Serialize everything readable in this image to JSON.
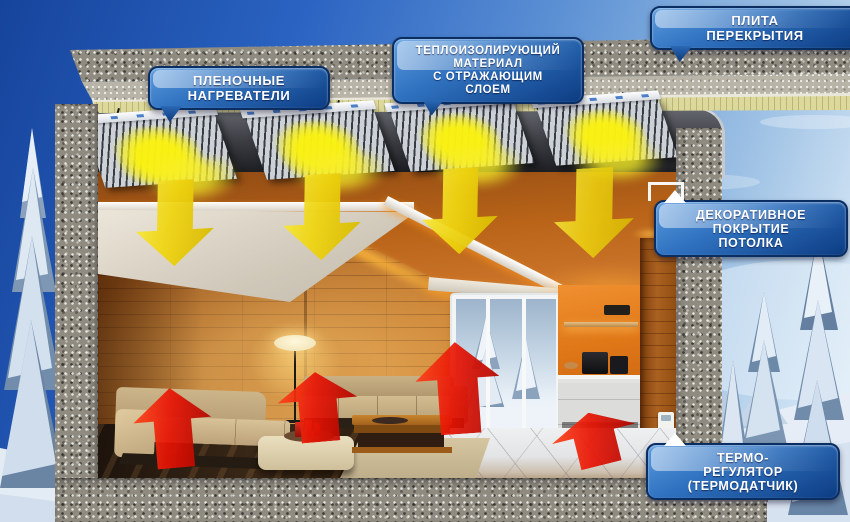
{
  "callouts": {
    "film_heaters": {
      "line1": "ПЛЕНОЧНЫЕ",
      "line2": "НАГРЕВАТЕЛИ"
    },
    "insulation": {
      "line1": "ТЕПЛОИЗОЛИРУЮЩИЙ",
      "line2": "МАТЕРИАЛ",
      "line3": "С ОТРАЖАЮЩИМ",
      "line4": "СЛОЕМ"
    },
    "slab": {
      "line1": "ПЛИТА",
      "line2": "ПЕРЕКРЫТИЯ"
    },
    "ceiling_cover": {
      "line1": "ДЕКОРАТИВНОЕ",
      "line2": "ПОКРЫТИЕ",
      "line3": "ПОТОЛКА"
    },
    "thermostat": {
      "line1": "ТЕРМО-",
      "line2": "РЕГУЛЯТОР",
      "line3": "(ТЕРМОДАТЧИК)"
    }
  },
  "colors": {
    "callout_blue_top": "#5a9ade",
    "callout_blue_bottom": "#0c3c82",
    "callout_border": "#0a2d62",
    "callout_text": "#ffffff",
    "heat_flow_down_yellow": "#efd411",
    "heat_flow_up_red": "#e81505",
    "heater_glow_yellow": "#faf212",
    "insulation_layer": "#ddd89b",
    "concrete_grey": "#8f8b81",
    "wood_wall_brown": "#b06a28",
    "kitchen_wall_orange": "#e07818",
    "sky_blue": "#2a63c2"
  }
}
